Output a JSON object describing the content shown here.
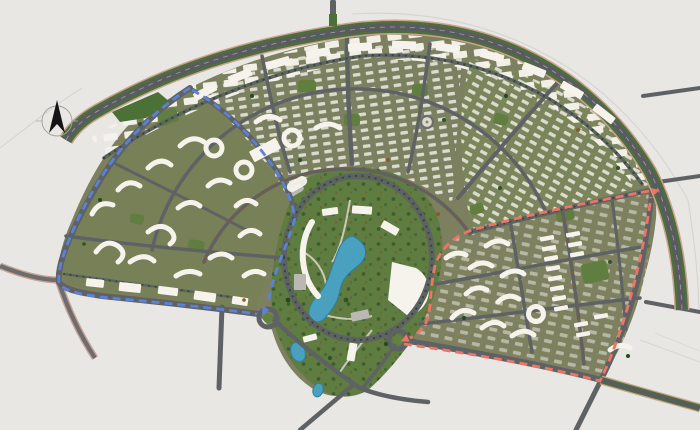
{
  "map": {
    "type": "masterplan-site-plan",
    "compass": {
      "icon": "north-arrow-icon",
      "color": "#141414"
    },
    "routes": [
      {
        "name": "west-loop-route",
        "color": "#5b82d8",
        "style": "dashed"
      },
      {
        "name": "east-loop-route",
        "color": "#ee7466",
        "style": "dashed"
      }
    ],
    "colors": {
      "background": "#e8e7e4",
      "road": "#5f6265",
      "road_edge": "#c9a291",
      "green_belt": "#4d6f38",
      "park": "#5f7d40",
      "water": "#4aa0bf",
      "buildings": "#f5f3ec",
      "block_base": "#7c805f",
      "pocket_green": "#5f7e40",
      "tree_dark": "#2f4d28",
      "tree_rust": "#8a572b"
    },
    "landmarks": [
      {
        "name": "central-park"
      },
      {
        "name": "lake"
      },
      {
        "name": "park-ring-road"
      },
      {
        "name": "greenbelt-boulevard"
      },
      {
        "name": "roundabout-west"
      },
      {
        "name": "roundabout-east"
      },
      {
        "name": "north-plaza-circle"
      }
    ],
    "districts": [
      {
        "name": "west-residential-district"
      },
      {
        "name": "north-central-residential-district"
      },
      {
        "name": "northeast-villa-district"
      },
      {
        "name": "east-residential-district"
      }
    ],
    "roundabout_count": 2
  }
}
